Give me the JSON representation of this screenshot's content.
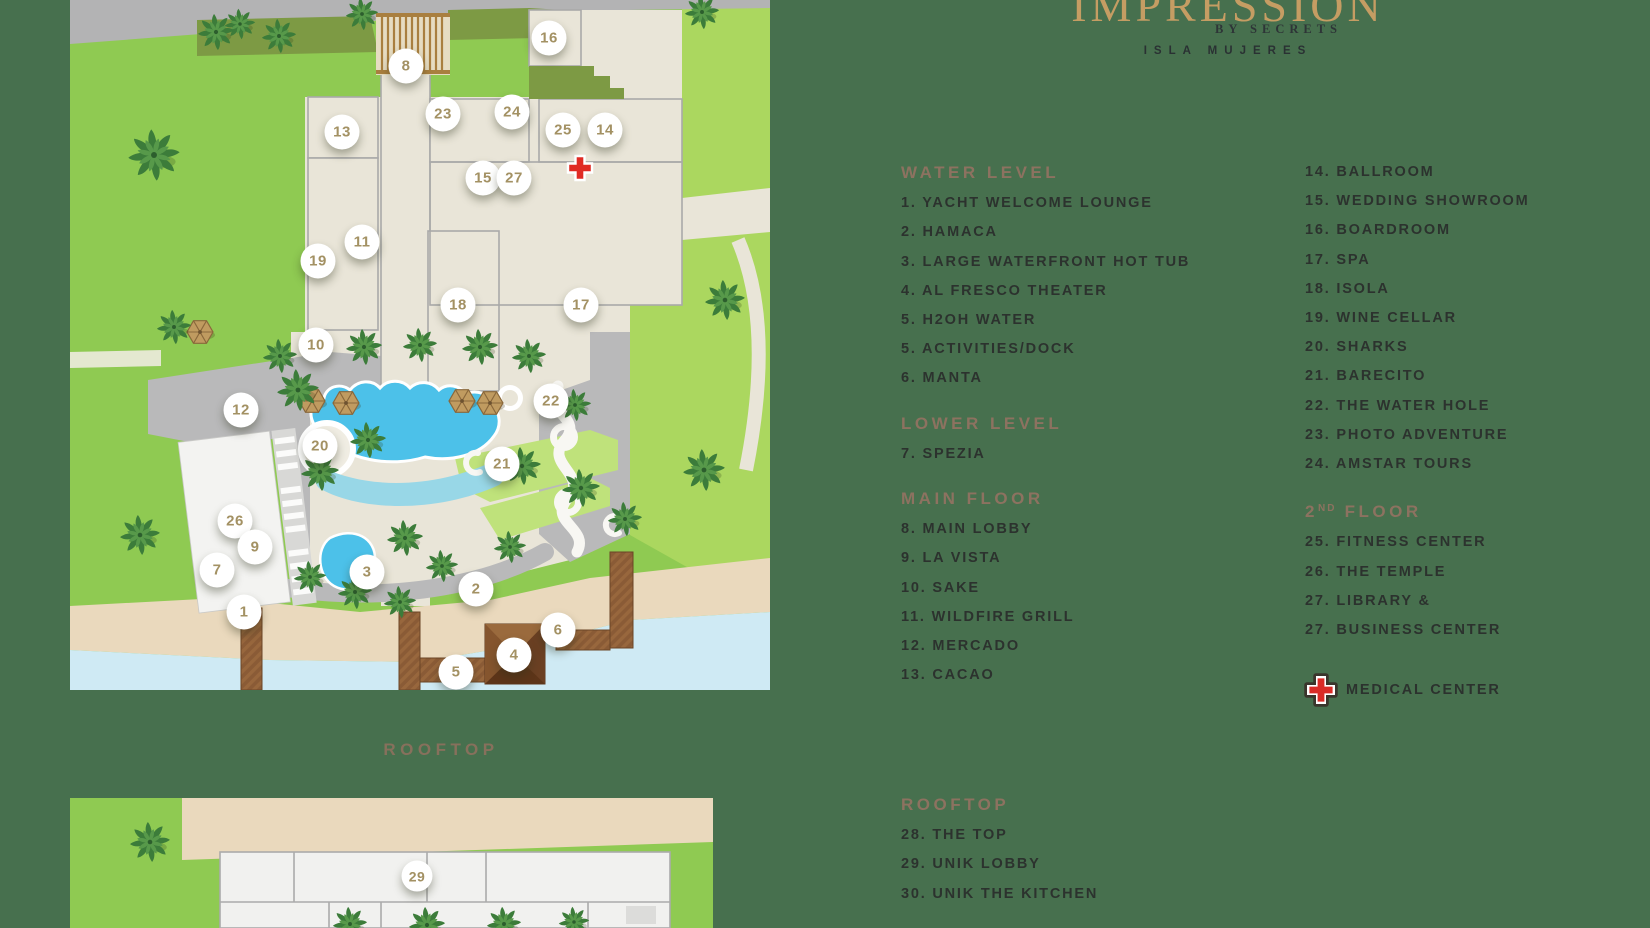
{
  "logo": {
    "name": "IMPRESSION",
    "by": "BY SECRETS",
    "location": "ISLA MUJERES"
  },
  "maps": {
    "rooftop_label": "ROOFTOP"
  },
  "legend": {
    "column1": [
      {
        "title": "WATER LEVEL",
        "items": [
          "1. YACHT WELCOME LOUNGE",
          "2. HAMACA",
          "3. LARGE WATERFRONT HOT TUB",
          "4. AL FRESCO THEATER",
          "5. H2OH WATER",
          "5. ACTIVITIES/DOCK",
          "6. MANTA"
        ]
      },
      {
        "title": "LOWER LEVEL",
        "items": [
          "7. SPEZIA"
        ]
      },
      {
        "title": "MAIN FLOOR",
        "items": [
          "8. MAIN LOBBY",
          "9. LA VISTA",
          "10. SAKE",
          "11. WILDFIRE GRILL",
          "12. MERCADO",
          "13. CACAO"
        ]
      }
    ],
    "column2": [
      {
        "title": "",
        "items": [
          "14. BALLROOM",
          "15. WEDDING SHOWROOM",
          "16. BOARDROOM",
          "17. SPA",
          "18. ISOLA",
          "19. WINE CELLAR",
          "20. SHARKS",
          "21. BARECITO",
          "22. THE WATER HOLE",
          "23. PHOTO ADVENTURE",
          "24. AMSTAR TOURS"
        ]
      },
      {
        "title_pre": "2",
        "title_sup": "ND",
        "title_post": " FLOOR",
        "items": [
          "25. FITNESS CENTER",
          "26. THE TEMPLE",
          "27. LIBRARY &",
          "27. BUSINESS CENTER"
        ]
      }
    ],
    "medical_label": "MEDICAL CENTER",
    "rooftop": {
      "title": "ROOFTOP",
      "items": [
        "28. THE TOP",
        "29. UNIK LOBBY",
        "30. UNIK THE KITCHEN"
      ]
    }
  },
  "map_markers": {
    "main": [
      {
        "n": "16",
        "x": 479,
        "y": 38
      },
      {
        "n": "8",
        "x": 336,
        "y": 66
      },
      {
        "n": "23",
        "x": 373,
        "y": 114
      },
      {
        "n": "24",
        "x": 442,
        "y": 112
      },
      {
        "n": "13",
        "x": 272,
        "y": 132
      },
      {
        "n": "25",
        "x": 493,
        "y": 130
      },
      {
        "n": "14",
        "x": 535,
        "y": 130
      },
      {
        "n": "15",
        "x": 413,
        "y": 178
      },
      {
        "n": "27",
        "x": 444,
        "y": 178
      },
      {
        "n": "19",
        "x": 248,
        "y": 261
      },
      {
        "n": "11",
        "x": 292,
        "y": 242
      },
      {
        "n": "18",
        "x": 388,
        "y": 305
      },
      {
        "n": "17",
        "x": 511,
        "y": 305
      },
      {
        "n": "10",
        "x": 246,
        "y": 345
      },
      {
        "n": "12",
        "x": 171,
        "y": 410
      },
      {
        "n": "22",
        "x": 481,
        "y": 401
      },
      {
        "n": "20",
        "x": 250,
        "y": 446
      },
      {
        "n": "21",
        "x": 432,
        "y": 464
      },
      {
        "n": "26",
        "x": 165,
        "y": 521
      },
      {
        "n": "9",
        "x": 185,
        "y": 547
      },
      {
        "n": "7",
        "x": 147,
        "y": 570
      },
      {
        "n": "3",
        "x": 297,
        "y": 572
      },
      {
        "n": "2",
        "x": 406,
        "y": 589
      },
      {
        "n": "1",
        "x": 174,
        "y": 612
      },
      {
        "n": "6",
        "x": 488,
        "y": 630
      },
      {
        "n": "4",
        "x": 444,
        "y": 655
      },
      {
        "n": "5",
        "x": 386,
        "y": 672
      }
    ],
    "rooftop": [
      {
        "n": "29",
        "x": 347,
        "y": 78
      }
    ]
  },
  "medical_cross_map": {
    "x": 510,
    "y": 168
  },
  "colors": {
    "background": "#47704e",
    "section_header": "#8d7260",
    "legend_text": "#2c322e",
    "marker_number": "#a39163",
    "logo_gold": "#c59d63",
    "medical_red": "#da2b26"
  }
}
